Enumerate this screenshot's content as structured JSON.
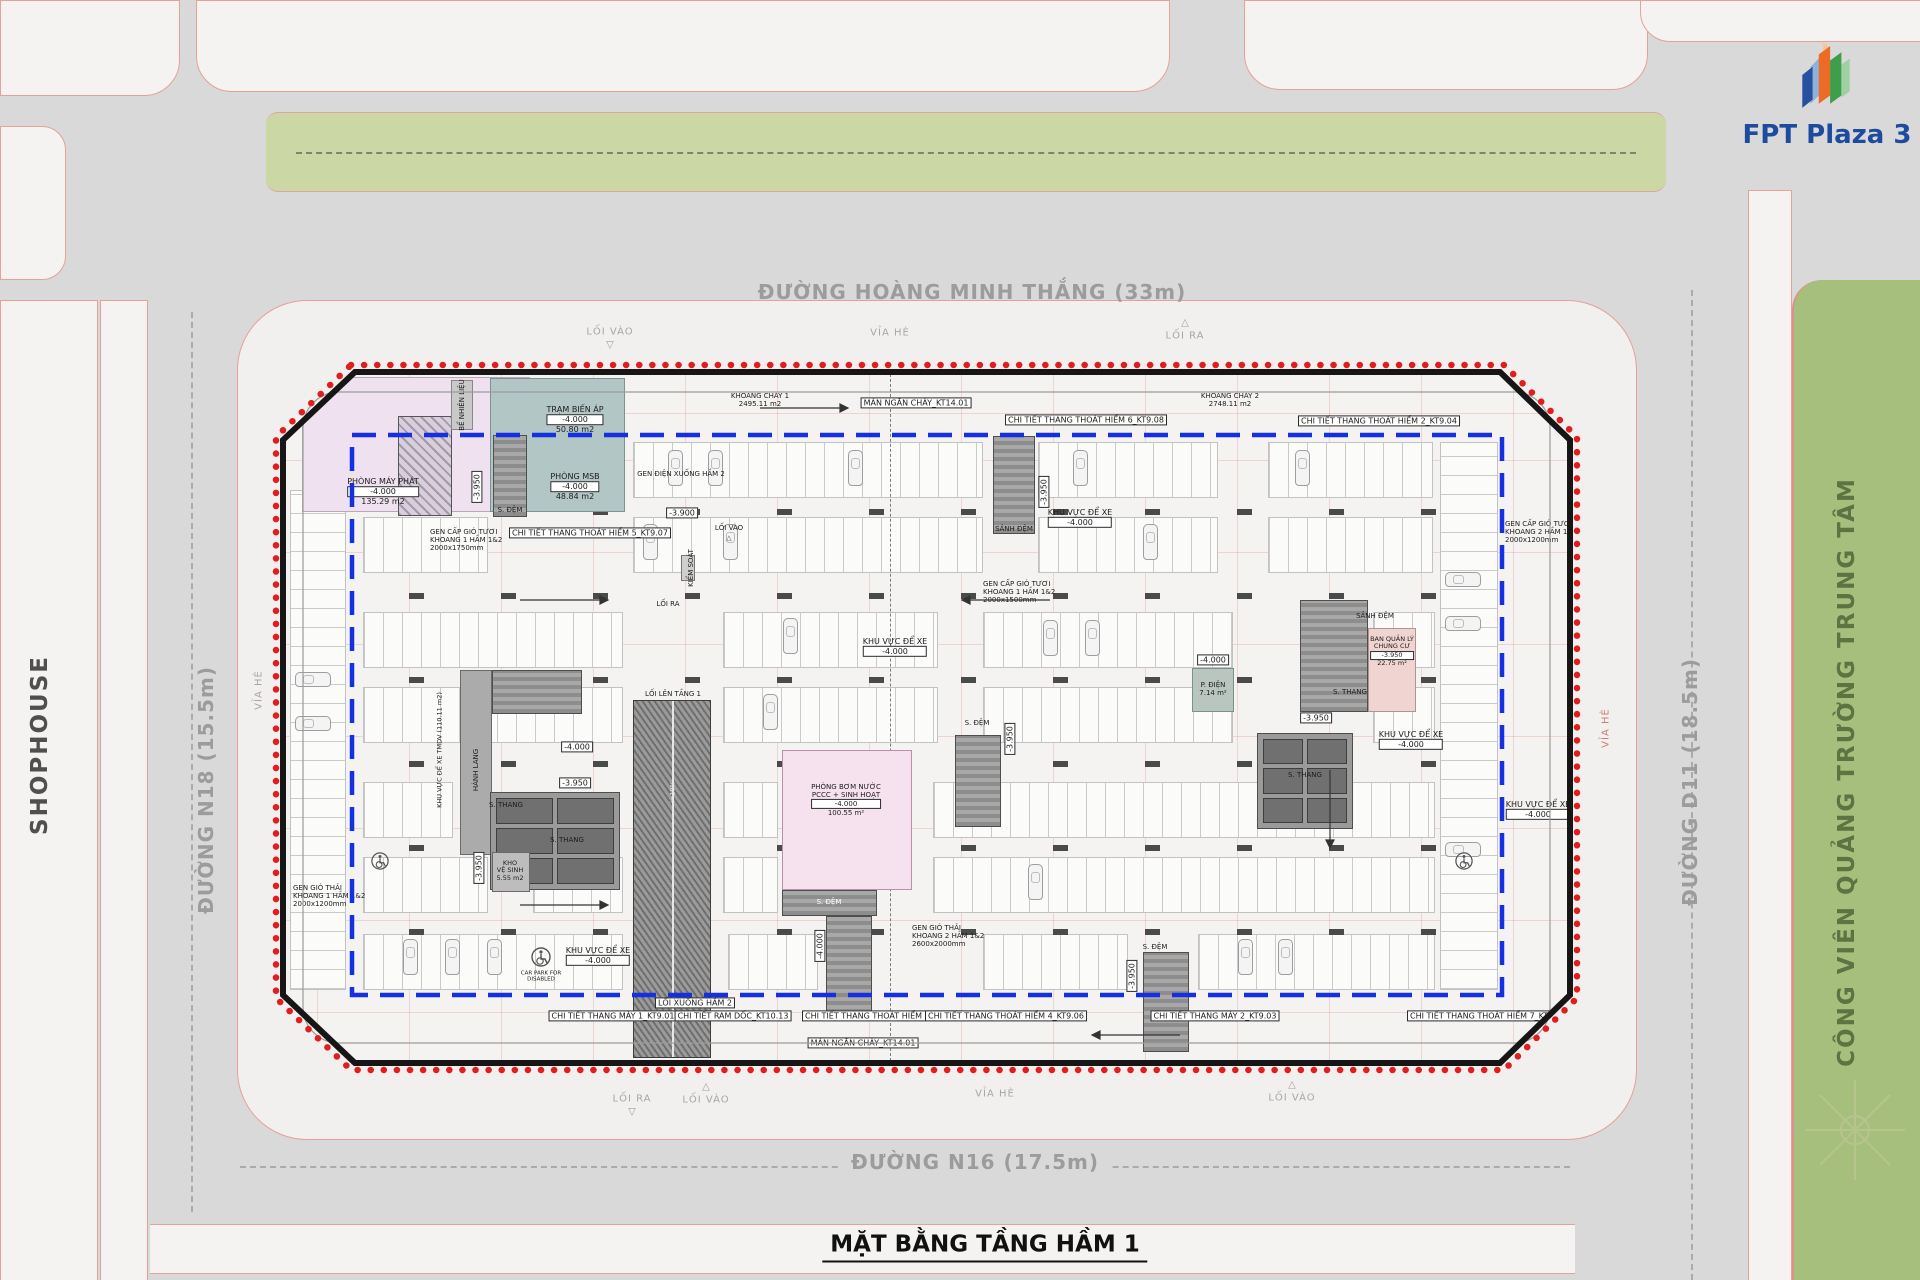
{
  "brand": "FPT Plaza 3",
  "drawing_title": "MẶT BẰNG TẦNG HẦM 1",
  "roads": {
    "top": "ĐƯỜNG HOÀNG MINH THẮNG (33m)",
    "bottom": "ĐƯỜNG N16 (17.5m)",
    "left": "ĐƯỜNG N18 (15.5m)",
    "right": "ĐƯỜNG D11 (18.5m)"
  },
  "context": {
    "shophouse": "SHOPHOUSE",
    "park": "CÔNG VIÊN QUẢNG TRƯỜNG TRUNG TÂM",
    "sidewalk": "VỈA HÈ"
  },
  "circulation": {
    "entry": "LỐI VÀO",
    "exit": "LỐI RA",
    "up_ramp": "LỐI LÊN TẦNG 1",
    "down_ramp": "LỐI XUỐNG HẦM 2",
    "slope": "i=10%",
    "control": "KIỂM SOÁT",
    "parking": "KHU VỰC ĐỂ XE",
    "parking_tmdv": "KHU VỰC ĐỂ XE TMDV (110.11 m2)",
    "corridor": "HÀNH LANG",
    "disabled1": "CAR PARK FOR",
    "disabled2": "DISABLED"
  },
  "levels": {
    "a": "-4.000",
    "b": "-3.950",
    "c": "-3.900"
  },
  "rooms": {
    "generator": {
      "name": "PHÒNG MÁY PHÁT",
      "area": "135.29 m2"
    },
    "transformer": {
      "name": "TRẠM BIẾN ÁP",
      "area": "50.80 m2"
    },
    "msb": {
      "name": "PHÒNG MSB",
      "area": "48.84 m2"
    },
    "fuel": "BỂ NHIÊN LIỆU",
    "pump1": "PHÒNG BƠM NƯỚC",
    "pump2": "PCCC + SINH HOẠT",
    "pump_area": "100.55 m²",
    "mgmt1": "BAN QUẢN LÝ",
    "mgmt2": "CHUNG CƯ",
    "mgmt_area": "22.75 m²",
    "elec": "P. ĐIỆN",
    "elec_area": "7.14 m²",
    "store1": "KHO",
    "store2": "VỆ SINH",
    "store_area": "5.55 m2",
    "stair": "S. THANG",
    "buffer": "S. ĐỆM",
    "lobby": "SẢNH ĐỆM"
  },
  "fire": {
    "c1name": "KHOANG CHÁY 1",
    "c1area": "2495.11 m2",
    "c2name": "KHOANG CHÁY 2",
    "c2area": "2748.11 m2",
    "curtain": "MÀN NGĂN CHÁY_KT14.01"
  },
  "details": {
    "stair5": "CHI TIẾT THANG THOÁT HIỂM 5_KT9.07",
    "stair6": "CHI TIẾT THANG THOÁT HIỂM 6_KT9.08",
    "stair2": "CHI TIẾT THANG THOÁT HIỂM 2_KT9.04",
    "stair3": "CHI TIẾT THANG THOÁT HIỂM 3_KT9.05",
    "stair4": "CHI TIẾT THANG THOÁT HIỂM 4_KT9.06",
    "stair7": "CHI TIẾT THANG THOÁT HIỂM 7_KT9.09",
    "lift1": "CHI TIẾT THANG MÁY 1_KT9.01",
    "lift2": "CHI TIẾT THANG MÁY 2_KT9.03",
    "ramp": "CHI TIẾT RAM DỐC_KT10.13"
  },
  "shafts": {
    "electric": "GEN ĐIỆN XUỐNG HẦM 2",
    "fresh": "GEN CẤP GIÓ TƯƠI",
    "exhaust": "GEN GIÓ THẢI",
    "bay1": "KHOANG 1 HẦM 1&2",
    "bay2": "KHOANG 2 HẦM 1&2",
    "size1750": "2000x1750mm",
    "size1500": "2000x1500mm",
    "size1200": "2000x1200mm",
    "size2600": "2600x2000mm"
  },
  "colors": {
    "boundary_red": "#e21d1d",
    "boundary_blue": "#1430e0",
    "brand_blue": "#1d4b9e"
  }
}
